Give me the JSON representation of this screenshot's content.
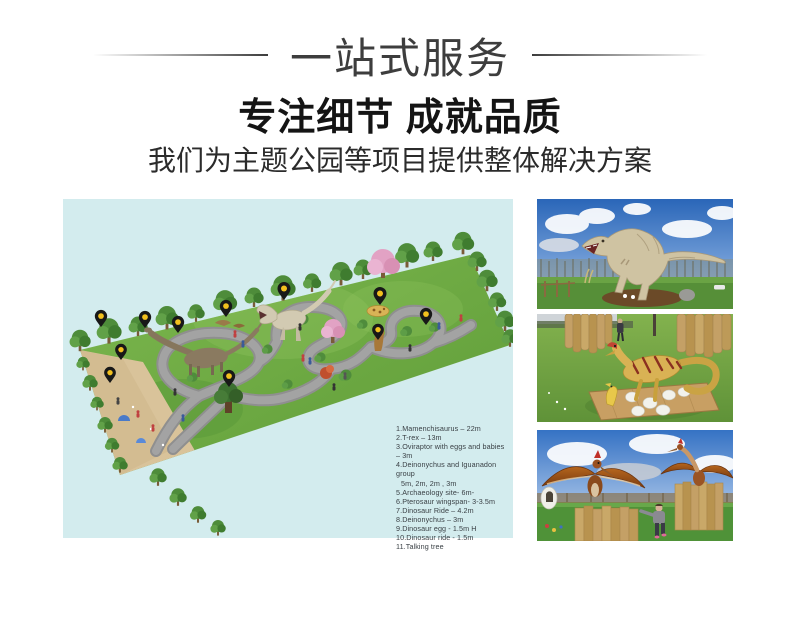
{
  "header": {
    "banner_title": "一站式服务",
    "headline": "专注细节 成就品质",
    "subheadline": "我们为主题公园等项目提供整体解决方案"
  },
  "park_plan": {
    "background_color": "#d3ecee",
    "pin_color": "#f2c01e",
    "legend_lines": [
      "1.Mamenchisaurus – 22m",
      "2.T-rex – 13m",
      "3.Oviraptor with eggs and babies – 3m",
      "4.Deinonychus and Iguanadon group",
      "5m, 2m, 2m , 3m",
      "5.Archaeology site- 6m-",
      "6.Pterosaur  wingspan- 3-3.5m",
      "7.Dinosaur Ride – 4.2m",
      "8.Deinonychus – 3m",
      "9.Dinosaur egg - 1.5m H",
      "10.Dinosaur ride -  1.5m",
      "11.Talking tree"
    ]
  }
}
